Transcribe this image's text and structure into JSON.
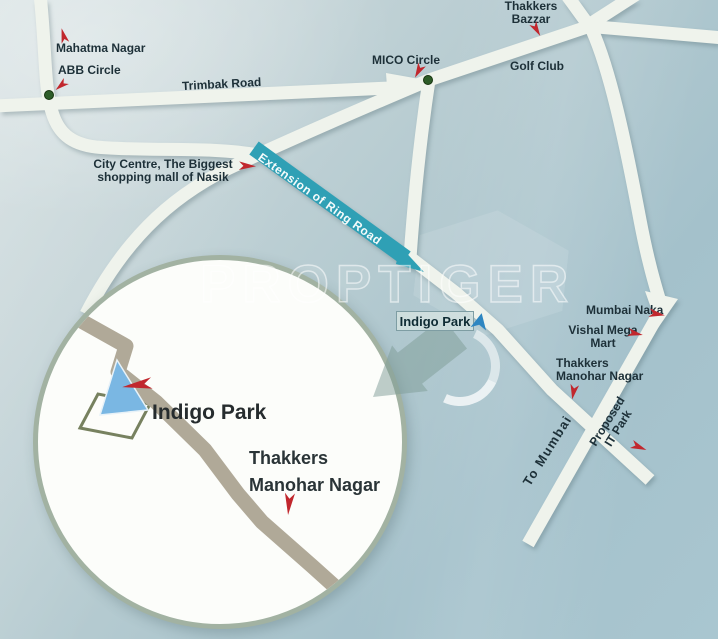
{
  "map": {
    "watermark": "PROPTIGER",
    "labels": {
      "mahatma_nagar": "Mahatma Nagar",
      "abb_circle": "ABB Circle",
      "trimbak_road": "Trimbak Road",
      "mico_circle": "MICO Circle",
      "thakkers_bazzar": {
        "line1": "Thakkers",
        "line2": "Bazzar"
      },
      "golf_club": "Golf Club",
      "city_centre": {
        "line1": "City Centre, The Biggest",
        "line2": "shopping mall of Nasik"
      },
      "ring_road": "Extension of Ring Road",
      "indigo_park_tag": "Indigo Park",
      "mumbai_naka": "Mumbai Naka",
      "vishal_mega_mart": {
        "line1": "Vishal Mega",
        "line2": "Mart"
      },
      "thakkers_manohar": {
        "line1": "Thakkers",
        "line2": "Manohar Nagar"
      },
      "to_mumbai": "To Mumbai",
      "proposed_it_park": {
        "line1": "Proposed",
        "line2": "IT Park"
      }
    },
    "inset": {
      "indigo_park": "Indigo Park",
      "thakkers": {
        "line1": "Thakkers",
        "line2": "Manohar Nagar"
      }
    },
    "colors": {
      "road": "#eff3ec",
      "ring_road_highlight": "#2fa0b5",
      "inset_road": "#b0a998",
      "marker_arrow_red": "#c1272d",
      "marker_arrow_blue": "#2e86c1",
      "junction_dot_green": "#2d5c28",
      "label_text": "#1d3038",
      "background_top": "#d2dedf",
      "background_bottom": "#a4c1cb",
      "inset_rim": "#a2b2a2",
      "indigo_plot_blue": "#7ab7e3"
    }
  }
}
